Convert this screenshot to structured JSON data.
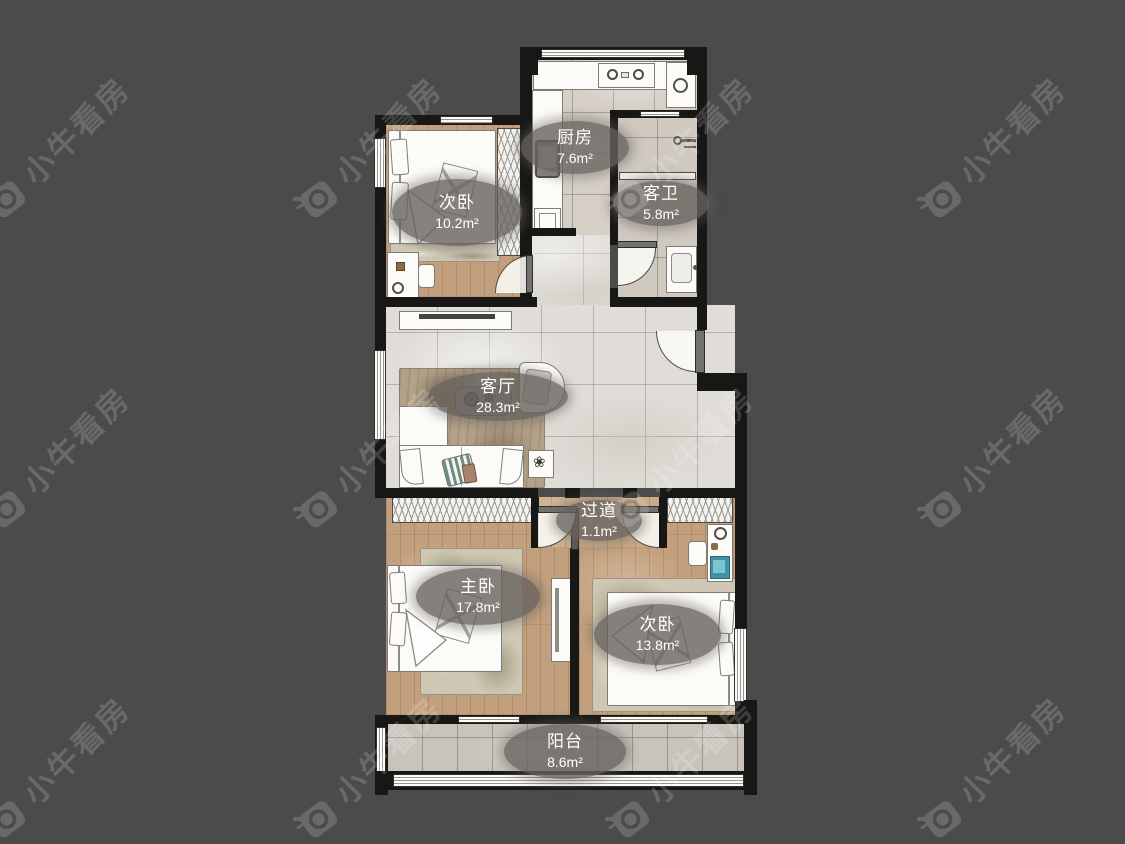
{
  "background_color": "#4b4b4c",
  "wall_color": "#171715",
  "label_pill_color": "rgba(103,98,93,0.8)",
  "watermark": {
    "text": "小牛看房"
  },
  "rooms": [
    {
      "id": "bedroom-north",
      "name": "次卧",
      "area": "10.2m²"
    },
    {
      "id": "kitchen",
      "name": "厨房",
      "area": "7.6m²"
    },
    {
      "id": "guest-bathroom",
      "name": "客卫",
      "area": "5.8m²"
    },
    {
      "id": "living-room",
      "name": "客厅",
      "area": "28.3m²"
    },
    {
      "id": "hallway",
      "name": "过道",
      "area": "1.1m²"
    },
    {
      "id": "master-bedroom",
      "name": "主卧",
      "area": "17.8m²"
    },
    {
      "id": "bedroom-southeast",
      "name": "次卧",
      "area": "13.8m²"
    },
    {
      "id": "balcony",
      "name": "阳台",
      "area": "8.6m²"
    }
  ]
}
